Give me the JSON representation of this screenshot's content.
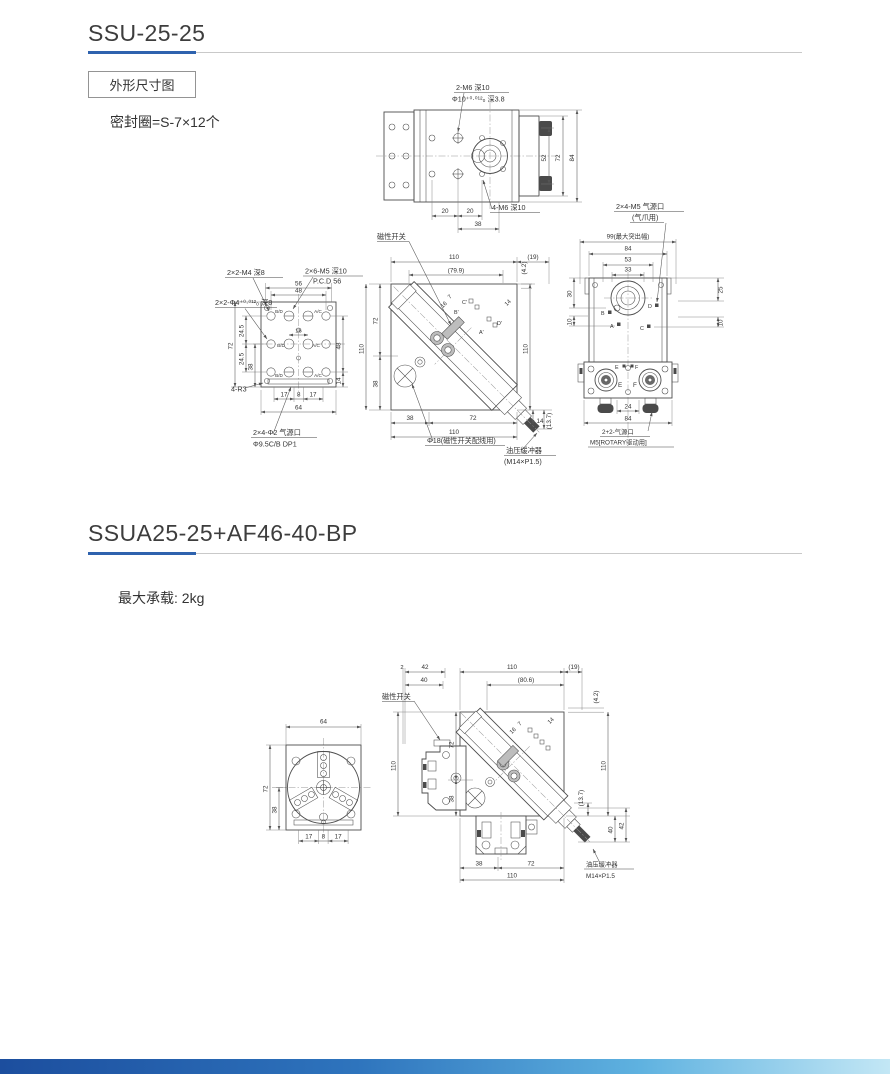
{
  "meta": {
    "accent_blue": "#2e62ae",
    "rule_gray": "#c9c9c9",
    "footer_gradient": [
      "#1c4e9e",
      "#5fb2e0",
      "#c3e7f5"
    ]
  },
  "s1": {
    "title": "SSU-25-25",
    "frame": "外形尺寸图",
    "seal": "密封圈=S-7×12个",
    "a": {
      "c1": "2-M6 深10",
      "c2": "Φ10⁺⁰·⁰¹²₀ 深3.8",
      "c3": "4-M6 深10",
      "d52": "52",
      "d72": "72",
      "d84": "84",
      "d20a": "20",
      "d20b": "20",
      "d38": "38"
    },
    "b": {
      "c1": "2×2-M4 深8",
      "c2": "2×6-M5 深10",
      "c2b": "P.C.D 56",
      "c3": "2×2-Φ4⁺⁰·⁰¹²₀ 深8",
      "c4": "4-R3",
      "c5": "2×4-Φ2 气源口",
      "c5b": "Φ9.5C/B DP1",
      "d56": "56",
      "d48": "48",
      "d72": "72",
      "d245a": "24.5",
      "d245b": "24.5",
      "d38": "38",
      "d16": "16",
      "d48r": "48",
      "d14": "14",
      "d17a": "17",
      "d8": "8",
      "d17b": "17",
      "d64": "64",
      "p1": "B/D",
      "p2": "A/C",
      "p3": "B/D",
      "p4": "A/C",
      "p5": "B/D",
      "p6": "A/C"
    },
    "c": {
      "c1": "磁性开关",
      "c2": "Φ18(磁性开关配线用)",
      "c3": "油压缓冲器",
      "c3b": "(M14×P1.5)",
      "d110t": "110",
      "d19": "(19)",
      "d799": "(79.9)",
      "d42": "(4.2)",
      "d110l": "110",
      "d72": "72",
      "d38": "38",
      "d110r": "110",
      "d16": "16",
      "d7": "7",
      "d14s": "14",
      "d38b": "38",
      "d72b": "72",
      "d110b": "110",
      "d14": "14",
      "d137": "(13.7)",
      "pb": "B'",
      "pc": "C'",
      "pd": "D'",
      "pa": "A'"
    },
    "d": {
      "c1": "2×4-M5 气源口",
      "c1b": "(气爪用)",
      "c2": "2+2-气源口",
      "c2b": "M5[ROTARY驱动用]",
      "d99": "99(最大突出幅)",
      "d84": "84",
      "d53": "53",
      "d33": "33",
      "d30": "30",
      "d10l": "10",
      "d25": "25",
      "d10r": "10",
      "d24": "24",
      "d84b": "84",
      "pb": "B",
      "pa": "A",
      "pd": "D",
      "pc": "C",
      "pe1": "E",
      "pf1": "F",
      "pe2": "E",
      "pf2": "F"
    }
  },
  "s2": {
    "title": "SSUA25-25+AF46-40-BP",
    "load": "最大承载: 2kg",
    "e": {
      "d64": "64",
      "d72": "72",
      "d38": "38",
      "d17a": "17",
      "d8": "8",
      "d17b": "17"
    },
    "f": {
      "c1": "磁性开关",
      "c2": "油压缓冲器",
      "c2b": "M14×P1.5",
      "d2": "2",
      "d42": "42",
      "d40": "40",
      "d110t": "110",
      "d806": "(80.6)",
      "d19": "(19)",
      "d42r": "(4.2)",
      "d110l": "110",
      "d72": "72",
      "d38": "38",
      "d110r": "110",
      "d137": "(13.7)",
      "d40r": "40",
      "d42b": "42",
      "d16": "16",
      "d7": "7",
      "d14": "14",
      "d38b": "38",
      "d72b": "72",
      "d110b": "110"
    }
  }
}
